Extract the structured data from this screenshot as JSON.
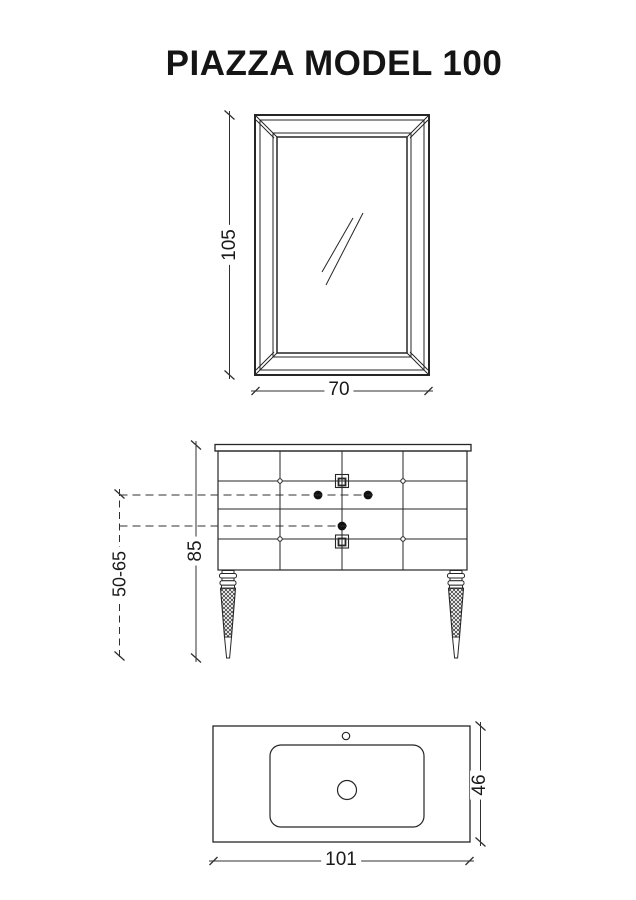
{
  "title": "PIAZZA MODEL 100",
  "views": {
    "mirror": {
      "height_cm": "105",
      "width_cm": "70"
    },
    "vanity": {
      "height_cm": "85",
      "supply_height_range_cm": "50-65"
    },
    "basin": {
      "width_cm": "101",
      "depth_cm": "46"
    }
  },
  "colors": {
    "ink": "#262626",
    "dimension_ink": "#303030",
    "background": "#ffffff"
  }
}
